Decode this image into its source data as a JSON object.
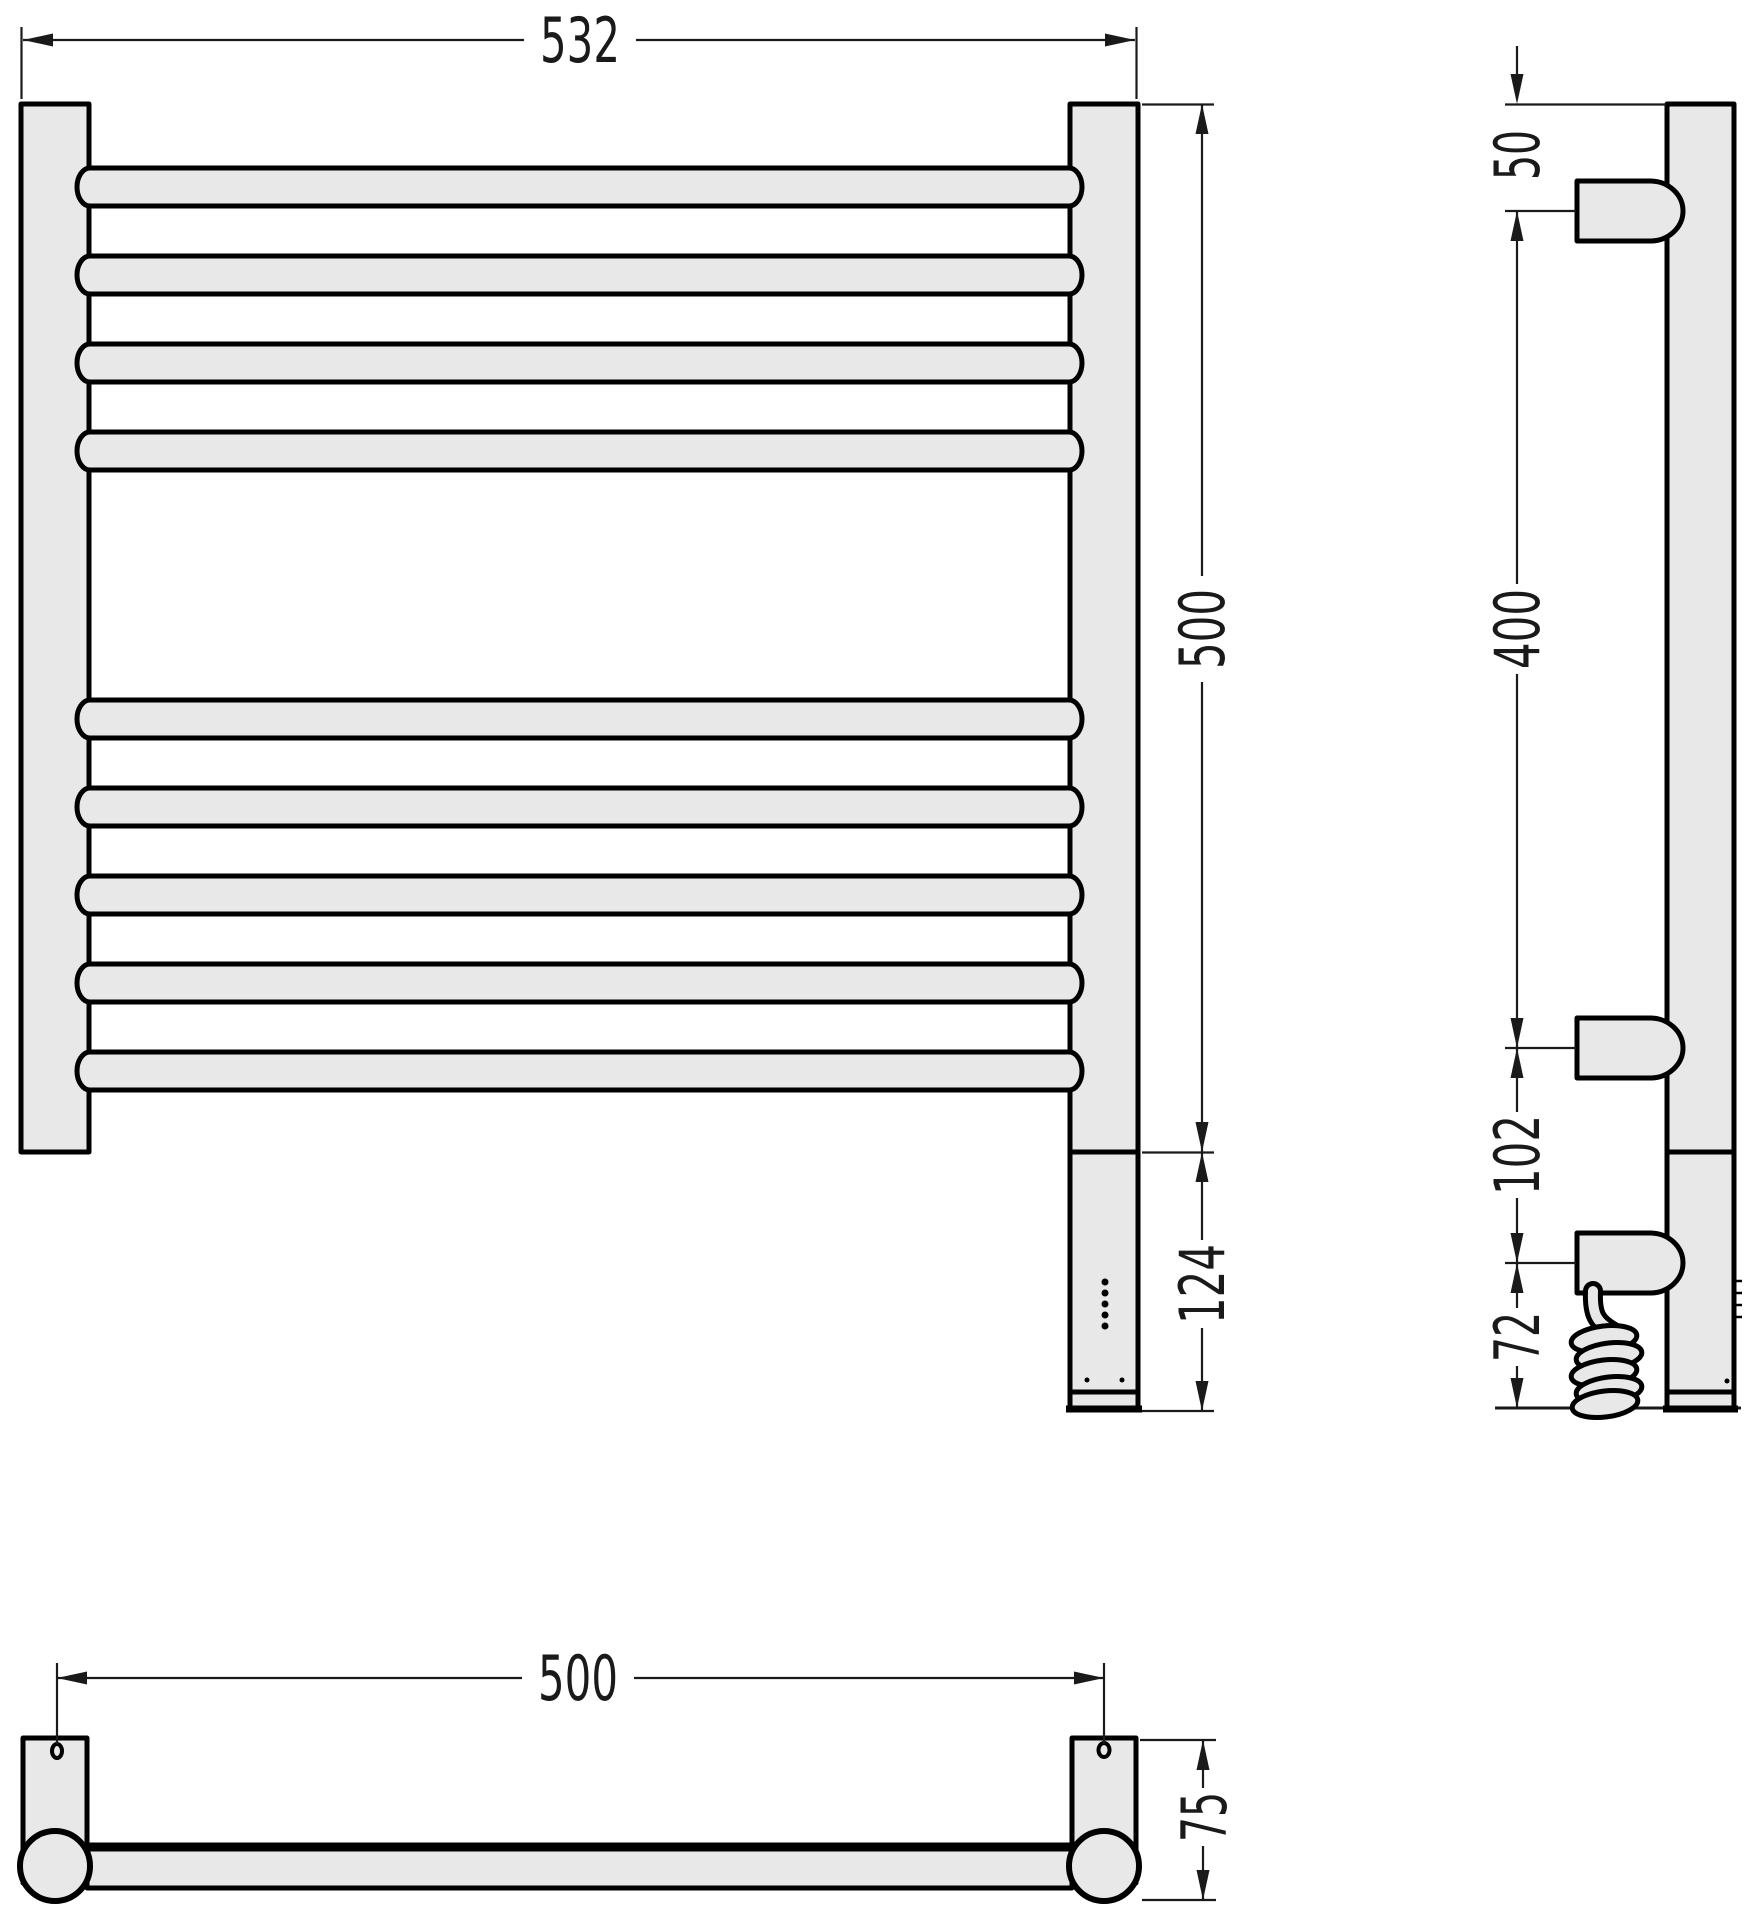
{
  "drawing": {
    "type": "technical-drawing",
    "subject": "ladder towel rail with electric control box, three orthographic views",
    "colors": {
      "background": "#ffffff",
      "part_fill": "#e8e8e8",
      "outline": "#000000",
      "dimension_lines": "#1a1a1a"
    },
    "dimensions": {
      "front": {
        "overall_width": "532",
        "rail_height": "500",
        "control_box_height": "124"
      },
      "side": {
        "top_to_bracket": "50",
        "bracket_span": "400",
        "bracket_gap": "102",
        "bracket_to_bottom": "72"
      },
      "top": {
        "mount_hole_spacing": "500",
        "wall_depth": "75"
      }
    }
  }
}
